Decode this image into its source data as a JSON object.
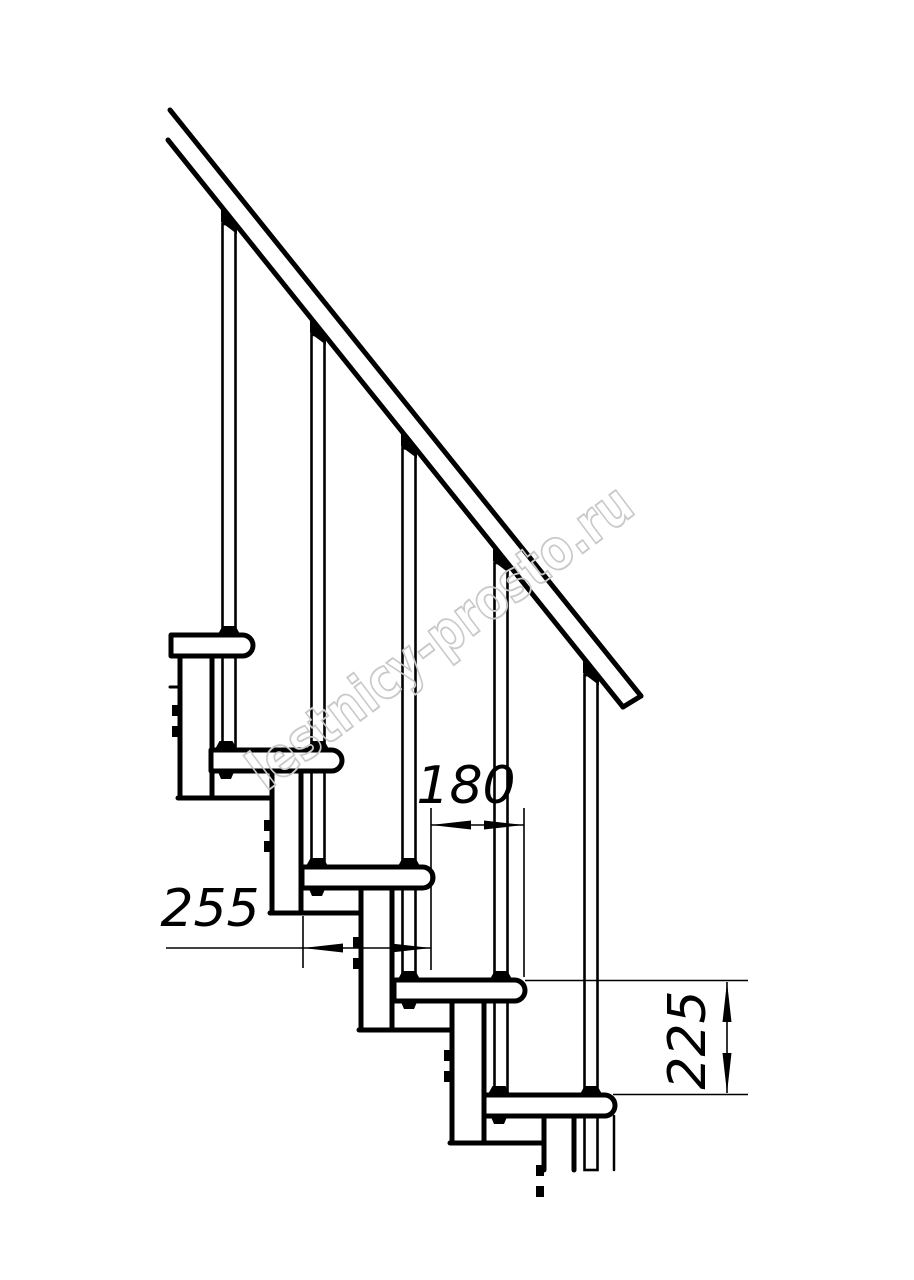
{
  "page": {
    "background": "#ffffff",
    "kind": "technical drawing, staircase side elevation"
  },
  "watermark": {
    "text": "lestnicy-prosto.ru",
    "color": "#c9c9c9",
    "angle_deg": -37
  },
  "drawing": {
    "stroke_color": "#000000",
    "background": "#ffffff",
    "tread_height": 21,
    "cutoff_y": 1170,
    "left_clip_x": 171,
    "treads": [
      {
        "nose": 253,
        "top": 635
      },
      {
        "nose": 342,
        "top": 750
      },
      {
        "nose": 433,
        "top": 867
      },
      {
        "nose": 525,
        "top": 980
      },
      {
        "nose": 615,
        "top": 1095
      }
    ],
    "rail": {
      "upper": [
        170,
        110,
        641,
        696
      ],
      "lower": [
        168,
        140,
        623,
        707
      ]
    },
    "dimensions": [
      {
        "label": "180",
        "value_mm": 180,
        "meaning": "step going (horizontal distance between tread noses)",
        "rotate": 0,
        "text_x": 466,
        "text_y": 803,
        "line": [
          431,
          825,
          524,
          825
        ],
        "ext": [
          [
            431,
            808,
            431,
            970
          ],
          [
            524,
            808,
            524,
            977
          ]
        ],
        "arrows": [
          [
            "left",
            431,
            825
          ],
          [
            "right",
            524,
            825
          ]
        ]
      },
      {
        "label": "255",
        "value_mm": 255,
        "meaning": "module length",
        "rotate": 0,
        "text_x": 210,
        "text_y": 926,
        "line": [
          166,
          948,
          431,
          948
        ],
        "ext": [
          [
            303,
            916,
            303,
            968
          ]
        ],
        "arrows": [
          [
            "left",
            303,
            948
          ],
          [
            "right",
            431,
            948
          ]
        ]
      },
      {
        "label": "225",
        "value_mm": 225,
        "meaning": "riser height (vertical distance between treads)",
        "rotate": -90,
        "text_x": 705,
        "text_y": 1040,
        "line": [
          727,
          982,
          727,
          1093
        ],
        "ext": [
          [
            525,
            980.5,
            748,
            980.5
          ],
          [
            613,
            1094.5,
            748,
            1094.5
          ]
        ],
        "arrows": [
          [
            "up",
            727,
            982
          ],
          [
            "down",
            727,
            1093
          ]
        ]
      }
    ]
  }
}
